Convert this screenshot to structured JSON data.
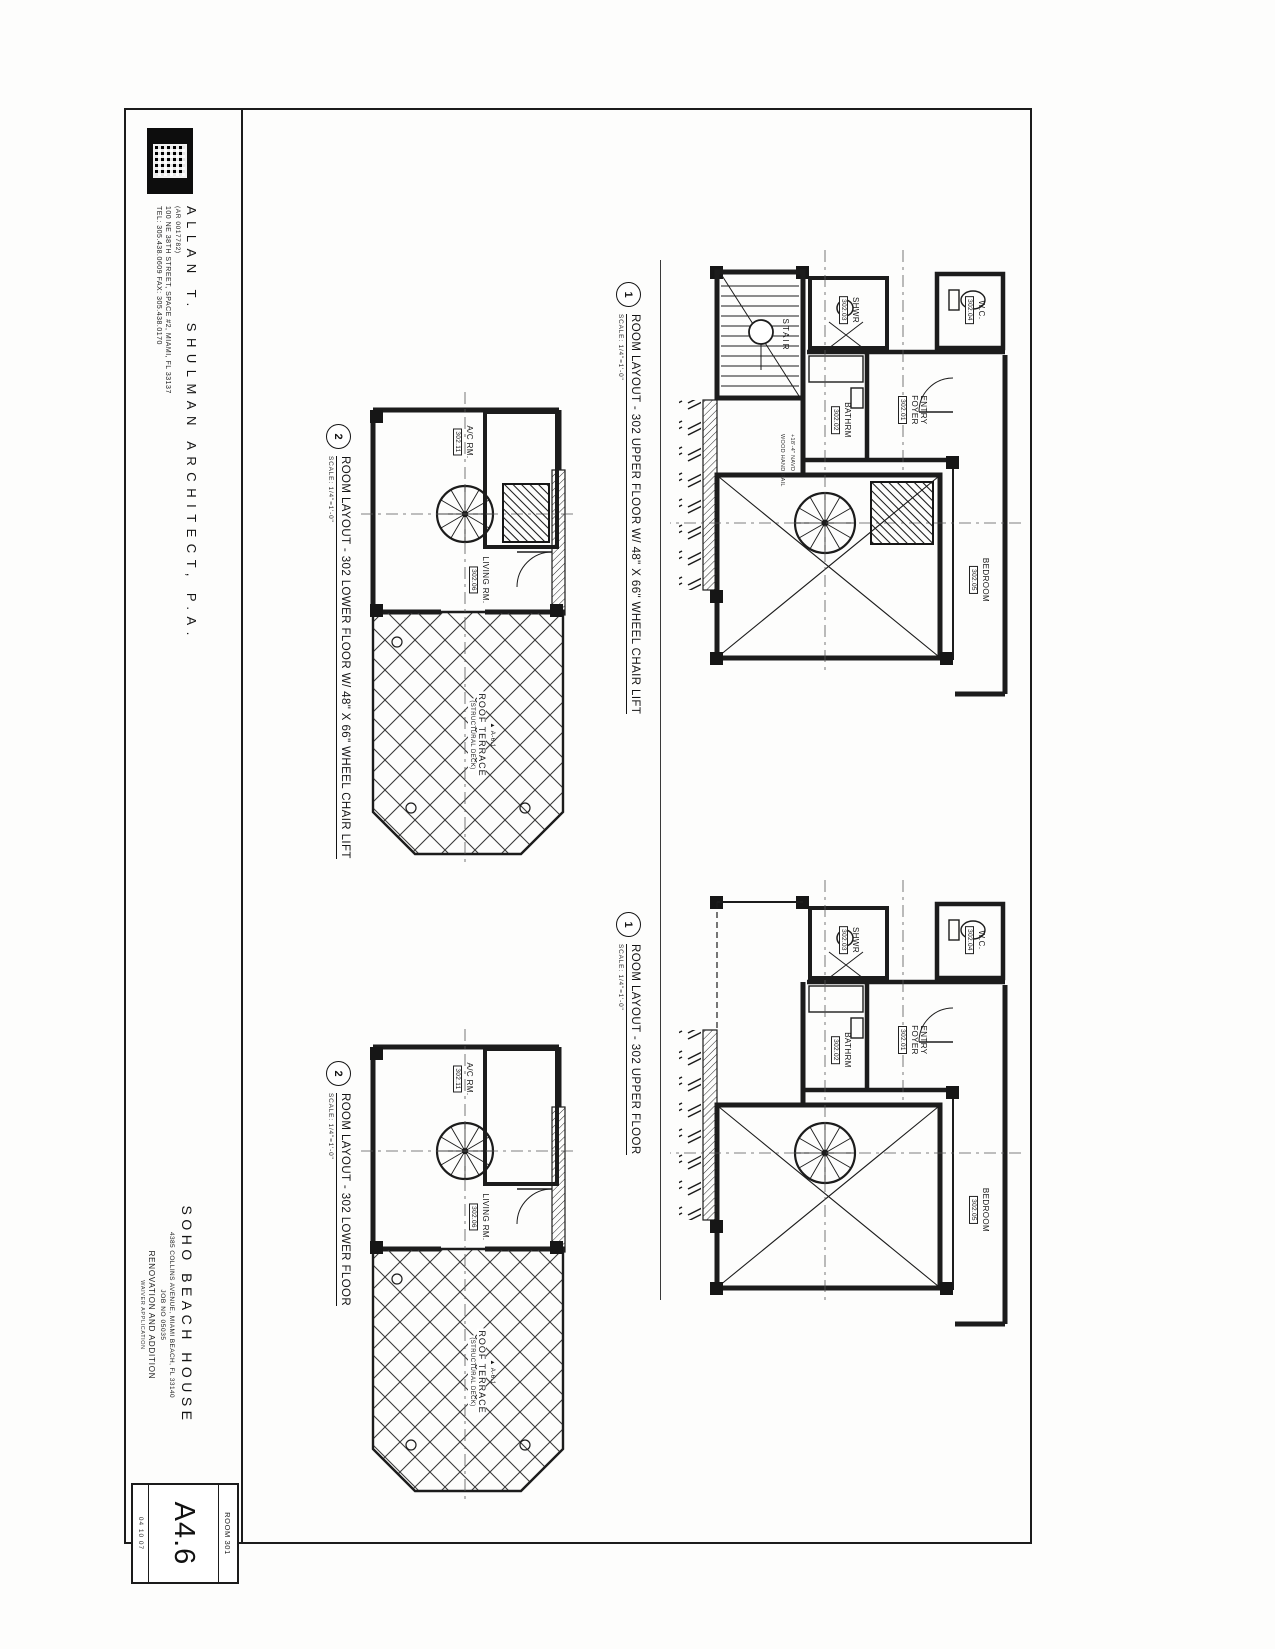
{
  "titleblock": {
    "architect_name": "ALLAN T. SHULMAN ARCHITECT, P.A.",
    "architect_license": "(AR 0017782)",
    "architect_address": "100 NE 38TH STREET, SPACE #2, MIAMI, FL 33137",
    "architect_phone": "TEL: 305.438.0609  FAX: 305.438.0170",
    "project_name": "SOHO BEACH HOUSE",
    "project_address": "4385 COLLINS AVENUE, MIAMI BEACH, FL 33140",
    "project_job": "JOB NO 05035",
    "project_phase": "RENOVATION AND ADDITION",
    "project_sub": "WAIVER APPLICATION",
    "sheet_room": "ROOM 301",
    "sheet_number": "A4.6",
    "sheet_date": "04 10 07"
  },
  "plans": [
    {
      "bubble": "1",
      "title": "ROOM LAYOUT - 302 UPPER FLOOR W/ 48\" X 66\" WHEEL CHAIR LIFT",
      "scale": "SCALE: 1/4\"=1'-0\""
    },
    {
      "bubble": "2",
      "title": "ROOM LAYOUT - 302 LOWER FLOOR W/ 48\" X 66\" WHEEL CHAIR LIFT",
      "scale": "SCALE: 1/4\"=1'-0\""
    },
    {
      "bubble": "1",
      "title": "ROOM LAYOUT - 302 UPPER FLOOR",
      "scale": "SCALE: 1/4\"=1'-0\""
    },
    {
      "bubble": "2",
      "title": "ROOM LAYOUT - 302 LOWER FLOOR",
      "scale": "SCALE: 1/4\"=1'-0\""
    }
  ],
  "rooms": {
    "stair": "STAIR",
    "entry": "ENTRY FOYER",
    "entry_tag": "302.01",
    "bathrm": "BATHRM",
    "bathrm_tag": "302.02",
    "shwr": "SHWR",
    "shwr_tag": "302.03",
    "wc": "W.C.",
    "wc_tag": "302.04",
    "bedroom": "BEDROOM",
    "bedroom_tag": "302.05",
    "living": "LIVING RM.",
    "living_tag": "302.06",
    "ac": "A/C RM.",
    "ac_tag": "302.11",
    "terrace_ref": "A-6.1",
    "terrace": "ROOF TERRACE",
    "terrace_sub": "(STRUCTURAL DECK)",
    "navd": "+18'-4\" NAVD",
    "handrail": "WOOD HAND RAIL"
  },
  "icons": {
    "section_marker": "▲"
  }
}
